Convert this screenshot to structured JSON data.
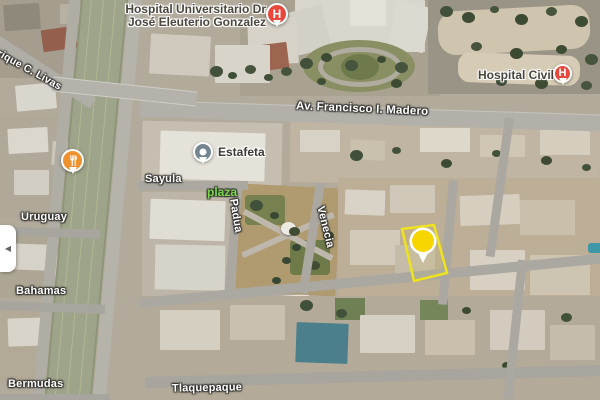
{
  "pois": {
    "hospital_universitario": {
      "line1": "Hospital Universitario Dr.",
      "line2": "José Eleuterio Gonzalez",
      "glyph": "H"
    },
    "hospital_civil": {
      "label": "Hospital Civil",
      "glyph": "H"
    },
    "estafeta": {
      "label": "Estafeta"
    }
  },
  "park": {
    "label": "plaza"
  },
  "streets": {
    "enrique_c_livas": "Enrique C. Livas",
    "av_francisco_madero": "Av. Francisco I. Madero",
    "sayula": "Sayula",
    "uruguay": "Uruguay",
    "bahamas": "Bahamas",
    "bermudas": "Bermudas",
    "tlaquepaque": "Tlaquepaque",
    "padua": "Padua",
    "venecia": "Venecia"
  },
  "controls": {
    "collapse_arrow": "◀"
  },
  "colors": {
    "hospital_pin": "#e8483b",
    "business_pin": "#74858f",
    "restaurant_pin": "#f09130",
    "selection_marker": "#f7d600",
    "parcel_outline": "#efe31c",
    "park_label": "#7fd94f"
  }
}
